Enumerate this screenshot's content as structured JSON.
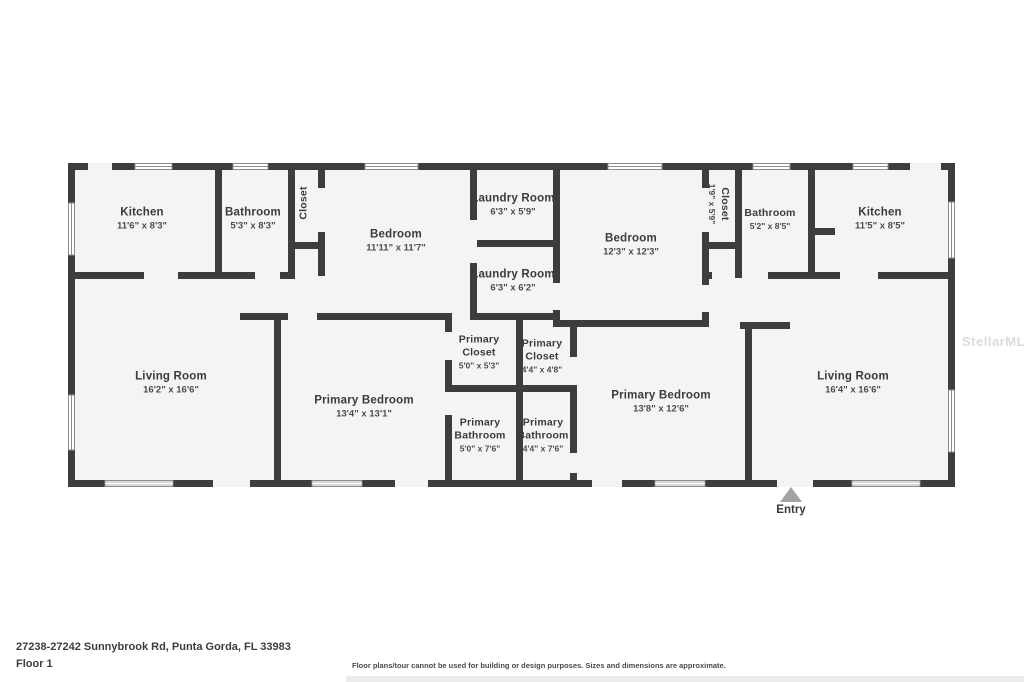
{
  "page": {
    "address": "27238-27242 Sunnybrook Rd, Punta Gorda, FL 33983",
    "floor_label": "Floor 1",
    "disclaimer": "Floor plans/tour cannot be used for building or design purposes. Sizes and dimensions are approximate.",
    "watermark": "StellarMLS"
  },
  "plan": {
    "entry_label": "Entry",
    "colors": {
      "wall": "#3d3d3d",
      "room_fill": "#f4f4f5",
      "window_frame": "#8c8c8c",
      "window_pane": "#d9d9d9",
      "entry_arrow": "#a3a3a3"
    },
    "rooms": [
      {
        "id": "kitchen-left",
        "name": "Kitchen",
        "dims": "11'6\" x 8'3\""
      },
      {
        "id": "bathroom-left",
        "name": "Bathroom",
        "dims": "5'3\" x 8'3\""
      },
      {
        "id": "closet-left",
        "name": "Closet",
        "dims": ""
      },
      {
        "id": "bedroom-left",
        "name": "Bedroom",
        "dims": "11'11\" x 11'7\""
      },
      {
        "id": "laundry-room-top",
        "name": "Laundry Room",
        "dims": "6'3\" x 5'9\""
      },
      {
        "id": "laundry-room-bottom",
        "name": "Laundry Room",
        "dims": "6'3\" x 6'2\""
      },
      {
        "id": "bedroom-right",
        "name": "Bedroom",
        "dims": "12'3\" x 12'3\""
      },
      {
        "id": "closet-right",
        "name": "Closet",
        "dims": "1'9\" x 5'9\""
      },
      {
        "id": "bathroom-right",
        "name": "Bathroom",
        "dims": "5'2\" x 8'5\""
      },
      {
        "id": "kitchen-right",
        "name": "Kitchen",
        "dims": "11'5\" x 8'5\""
      },
      {
        "id": "living-room-left",
        "name": "Living Room",
        "dims": "16'2\" x 16'6\""
      },
      {
        "id": "primary-bedroom-left",
        "name": "Primary Bedroom",
        "dims": "13'4\" x 13'1\""
      },
      {
        "id": "primary-closet-left",
        "name": "Primary Closet",
        "dims": "5'0\" x 5'3\""
      },
      {
        "id": "primary-closet-right",
        "name": "Primary Closet",
        "dims": "4'4\" x 4'8\""
      },
      {
        "id": "primary-bathroom-left",
        "name": "Primary Bathroom",
        "dims": "5'0\" x 7'6\""
      },
      {
        "id": "primary-bathroom-right",
        "name": "Primary Bathroom",
        "dims": "4'4\" x 7'6\""
      },
      {
        "id": "primary-bedroom-right",
        "name": "Primary Bedroom",
        "dims": "13'8\" x 12'6\""
      },
      {
        "id": "living-room-right",
        "name": "Living Room",
        "dims": "16'4\" x 16'6\""
      }
    ]
  }
}
